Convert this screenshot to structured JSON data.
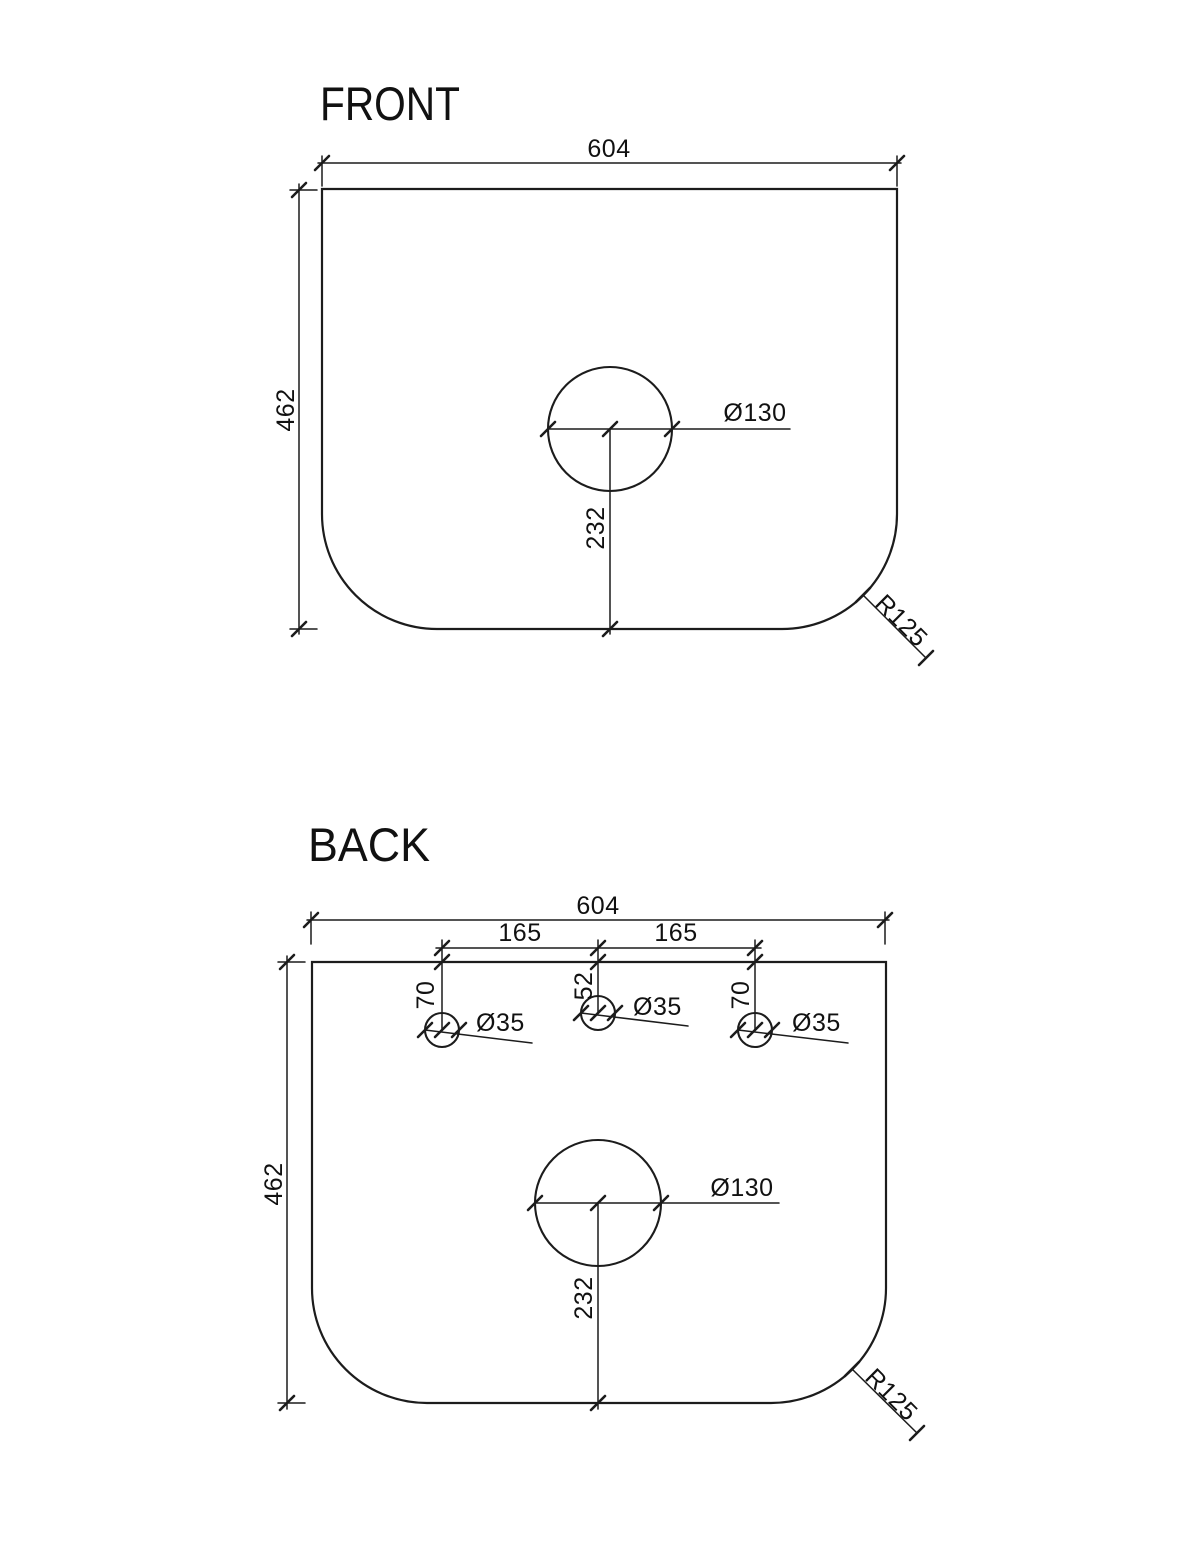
{
  "colors": {
    "line": "#1c1c1c",
    "text": "#111111",
    "background": "#ffffff"
  },
  "front": {
    "title": "FRONT",
    "width": "604",
    "height": "462",
    "basin_hole_diameter": "Ø130",
    "basin_hole_from_bottom": "232",
    "corner_radius": "R125"
  },
  "back": {
    "title": "BACK",
    "width": "604",
    "height": "462",
    "tap_spacing_left": "165",
    "tap_spacing_right": "165",
    "tap_offset_left": "70",
    "tap_offset_center": "52",
    "tap_offset_right": "70",
    "tap_diameter_left": "Ø35",
    "tap_diameter_center": "Ø35",
    "tap_diameter_right": "Ø35",
    "basin_hole_diameter": "Ø130",
    "basin_hole_from_bottom": "232",
    "corner_radius": "R125"
  }
}
